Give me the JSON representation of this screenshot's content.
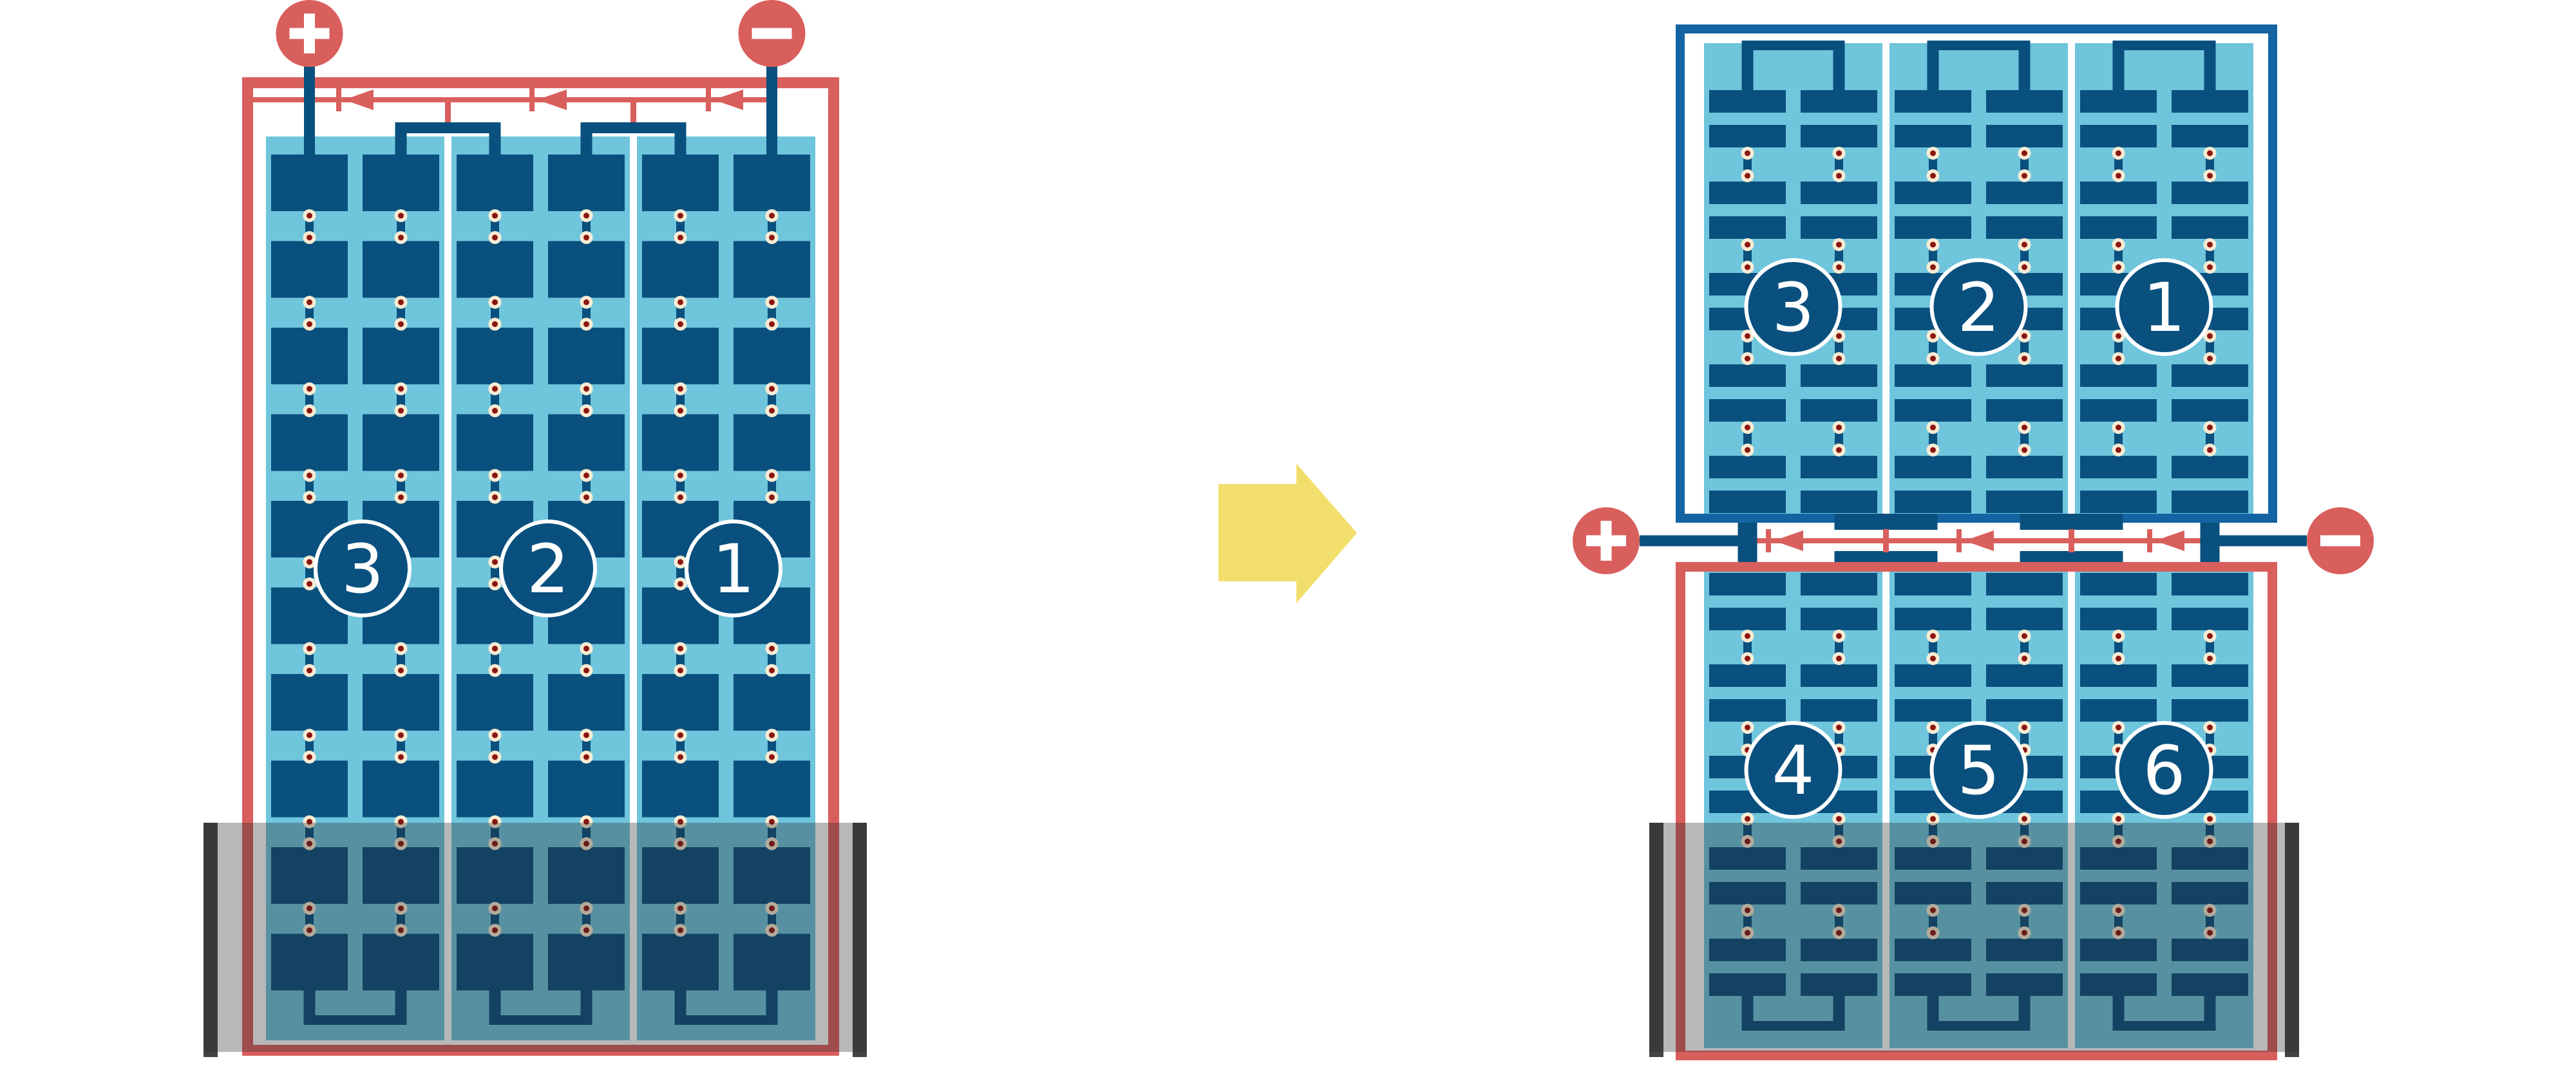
{
  "page": {
    "background": "#ffffff",
    "description": "Solar module string wiring diagram: one flooded panel reconfigured into an upper dry panel and a lower flooded panel"
  },
  "colors": {
    "wire_red": "#D95F5D",
    "cell_navy": "#09507E",
    "frame_blue": "#1464A3",
    "panel_light_blue": "#6FC5DC",
    "solder_cream": "#F8ECD4",
    "solder_dot_red": "#8C150F",
    "flood_wall_gray": "#434345",
    "water_overlay": "rgba(40,40,44,0.33)",
    "arrow_yellow": "#F2DF6B",
    "white": "#FFFFFF"
  },
  "before_panel": {
    "terminals": {
      "positive_label": "+",
      "negative_label": "-"
    },
    "strings": [
      {
        "number": "3"
      },
      {
        "number": "2"
      },
      {
        "number": "1"
      }
    ],
    "bypass_diode_count": 3,
    "flooded": true
  },
  "after_assembly": {
    "top_panel": {
      "strings": [
        {
          "number": "3"
        },
        {
          "number": "2"
        },
        {
          "number": "1"
        }
      ],
      "flooded": false
    },
    "bottom_panel": {
      "strings": [
        {
          "number": "4"
        },
        {
          "number": "5"
        },
        {
          "number": "6"
        }
      ],
      "flooded": true
    },
    "terminals": {
      "positive_label": "+",
      "negative_label": "-"
    },
    "bypass_diode_count": 3
  },
  "transition": {
    "arrow_icon": "arrow-right"
  }
}
